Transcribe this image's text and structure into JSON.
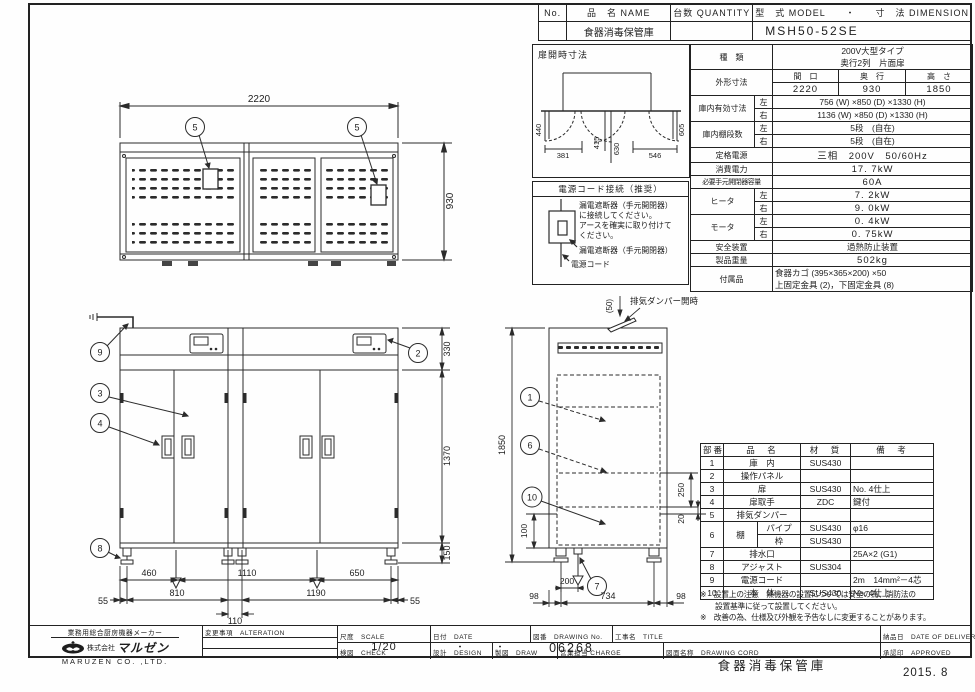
{
  "header_table": {
    "col_no": "No.",
    "col_name": "品　名 NAME",
    "col_qty": "台数 QUANTITY",
    "col_model": "型　式 MODEL　　・　　寸　法 DIMENSION",
    "name": "食器消毒保管庫",
    "model": "MSH50-52SE"
  },
  "spec_table": {
    "kind_label": "種　類",
    "kind_value_1": "200V大型タイプ",
    "kind_value_2": "奥行2列　片面扉",
    "outer_label": "外形寸法",
    "width_label": "間　口",
    "depth_label": "奥　行",
    "height_label": "高　さ",
    "width": "2220",
    "depth": "930",
    "height": "1850",
    "inner_label": "庫内有効寸法",
    "left_label": "左",
    "right_label": "右",
    "inner_left": "756 (W) ×850 (D) ×1330 (H)",
    "inner_right": "1136 (W) ×850 (D) ×1330 (H)",
    "shelf_label": "庫内棚段数",
    "shelf_left": "5段　(自在)",
    "shelf_right": "5段　(自在)",
    "power_label": "定格電源",
    "power": "三相　200V　50/60Hz",
    "consumption_label": "消費電力",
    "consumption": "17. 7kW",
    "breaker_label": "必要手元開閉器容量",
    "breaker": "60A",
    "heater_label": "ヒータ",
    "heater_left": "7. 2kW",
    "heater_right": "9. 0kW",
    "motor_label": "モータ",
    "motor_left": "0. 4kW",
    "motor_right": "0. 75kW",
    "safety_label": "安全装置",
    "safety": "過熱防止装置",
    "weight_label": "製品重量",
    "weight": "502kg",
    "accessory_label": "付属品",
    "accessory_1": "食器カゴ (395×365×200) ×50",
    "accessory_2": "上固定金具 (2)，下固定金具 (8)"
  },
  "door_open_box": {
    "title": "扉開時寸法",
    "d440": "440",
    "d381": "381",
    "d415": "415",
    "d630": "630",
    "d546": "546",
    "d605": "605"
  },
  "power_cord_box": {
    "title": "電源コード接続（推奨）",
    "line1": "漏電遮断器（手元開閉器）",
    "line2": "に接続してください。",
    "line3": "アースを確実に取り付けて",
    "line4": "ください。",
    "label_breaker": "漏電遮断器（手元開閉器）",
    "label_cord": "電源コード"
  },
  "plan_view": {
    "width": "2220",
    "depth": "930",
    "balloon": "5"
  },
  "front_view": {
    "balloon_9": "9",
    "balloon_2": "2",
    "balloon_3": "3",
    "balloon_4": "4",
    "balloon_8": "8",
    "dim_330": "330",
    "dim_1370": "1370",
    "dim_150": "150",
    "dim_460": "460",
    "dim_1110": "1110",
    "dim_650": "650",
    "dim_55l": "55",
    "dim_810": "810",
    "dim_1190": "1190",
    "dim_55r": "55",
    "dim_110": "110"
  },
  "side_view": {
    "balloon_1": "1",
    "balloon_6": "6",
    "balloon_10": "10",
    "balloon_7": "7",
    "damper_label": "排気ダンパー開時",
    "dim_50": "(50)",
    "dim_1850": "1850",
    "dim_100": "100",
    "dim_200": "200",
    "dim_250": "250",
    "dim_20": "20",
    "dim_98l": "98",
    "dim_734": "734",
    "dim_98r": "98"
  },
  "parts_table": {
    "h_no": "部番",
    "h_name": "品　名",
    "h_material": "材　質",
    "h_note": "備　考",
    "rows": [
      {
        "no": "1",
        "name": "庫　内",
        "mat": "SUS430",
        "note": ""
      },
      {
        "no": "2",
        "name": "操作パネル",
        "mat": "",
        "note": ""
      },
      {
        "no": "3",
        "name": "扉",
        "mat": "SUS430",
        "note": "No. 4仕上"
      },
      {
        "no": "4",
        "name": "扉取手",
        "mat": "ZDC",
        "note": "鍵付"
      },
      {
        "no": "5",
        "name": "排気ダンパー",
        "mat": "",
        "note": ""
      },
      {
        "no": "6",
        "name": "棚",
        "sub1": "パイプ",
        "mat1": "SUS430",
        "note1": "φ16",
        "sub2": "枠",
        "mat2": "SUS430",
        "note2": ""
      },
      {
        "no": "7",
        "name": "排水口",
        "mat": "",
        "note": "25A×2 (G1)"
      },
      {
        "no": "8",
        "name": "アジャスト",
        "mat": "SUS304",
        "note": ""
      },
      {
        "no": "9",
        "name": "電源コード",
        "mat": "",
        "note": "2m　14mm²－4芯"
      },
      {
        "no": "10",
        "name": "本　体",
        "mat": "SUS430",
        "note": "No. 4仕上"
      }
    ]
  },
  "notes": {
    "n1a": "※　設置上の注意　熱機器の設置については安全の為、消防法の",
    "n1b": "　　設置基準に従って設置してください。",
    "n2": "※　改善の為、仕様及び外観を予告なしに変更することがあります。"
  },
  "title_block": {
    "tagline": "業務用総合厨房機器メーカー",
    "company_prefix": "株式会社",
    "company": "マルゼン",
    "company_en": "MARUZEN  CO. ,LTD.",
    "alteration": "変更事項　ALTERATION",
    "scale_label": "尺度　SCALE",
    "scale": "1/20",
    "date_label": "日付　DATE",
    "date": "・　　　・",
    "check_label": "検図　CHECK",
    "design_label": "設計　DESIGN",
    "draw_label": "製図　DRAW",
    "charge_label": "営業担当 CHARGE",
    "dwg_no_label": "図番　DRAWING No.",
    "dwg_no": "06268",
    "title_label": "工事名　TITLE",
    "dwg_name_label": "図面名称　DRAWING CORD",
    "dwg_name": "食器消毒保管庫",
    "delivery_label": "納品日　DATE OF DELIVERY",
    "approved_label": "承認印　APPROVED",
    "issue_date": "2015. 8"
  }
}
